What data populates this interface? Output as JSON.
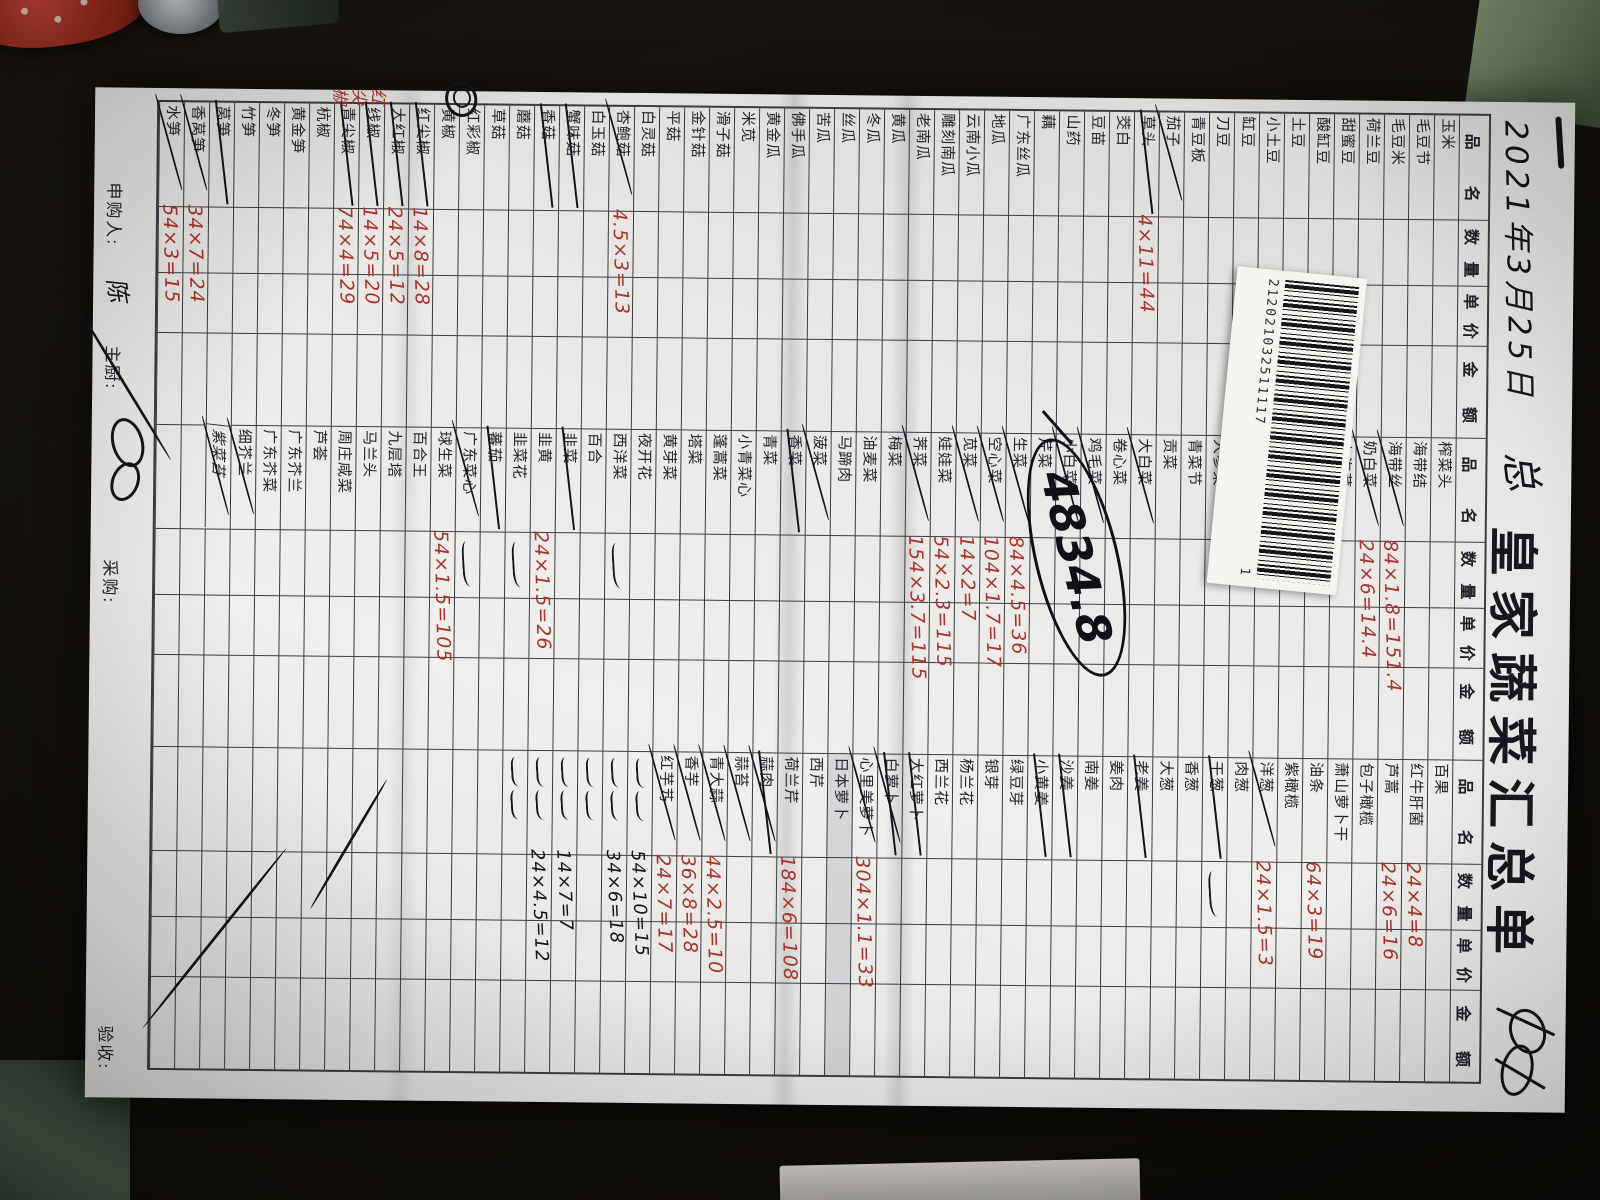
{
  "document": {
    "kind": "handwritten-vegetable-order-summary-photo",
    "date": "2021年3月25日",
    "date_mark": "总",
    "title": "皇家蔬菜汇总单",
    "circled_total": "4834.8",
    "margin_note_red": "红尖椒",
    "barcode_number": "212021032511117",
    "barcode_suffix": "1"
  },
  "footer": {
    "requester_label": "申购人:",
    "requester_signature": "陈",
    "chef_label": "主厨:",
    "buyer_label": "采购:",
    "receiver_label": "验收:"
  },
  "table": {
    "headers": [
      "品名",
      "数量",
      "单价",
      "金额"
    ],
    "rows_per_group": 52,
    "groups": [
      {
        "items": [
          {
            "n": "玉米"
          },
          {
            "n": "毛豆节"
          },
          {
            "n": "毛豆米"
          },
          {
            "n": "荷兰豆"
          },
          {
            "n": "甜蜜豆"
          },
          {
            "n": "酸缸豆"
          },
          {
            "n": "土豆"
          },
          {
            "n": "小土豆"
          },
          {
            "n": "缸豆"
          },
          {
            "n": "刀豆"
          },
          {
            "n": "青豆板"
          },
          {
            "n": "茄子",
            "c": 1
          },
          {
            "n": "草头",
            "s": 1,
            "r": "4×11=44"
          },
          {
            "n": "茭白"
          },
          {
            "n": "豆苗"
          },
          {
            "n": "山药"
          },
          {
            "n": "藕"
          },
          {
            "n": "广东丝瓜"
          },
          {
            "n": "地瓜"
          },
          {
            "n": "云南小瓜"
          },
          {
            "n": "雕刻南瓜"
          },
          {
            "n": "老南瓜"
          },
          {
            "n": "黄瓜"
          },
          {
            "n": "冬瓜"
          },
          {
            "n": "丝瓜"
          },
          {
            "n": "苦瓜"
          },
          {
            "n": "佛手瓜"
          },
          {
            "n": "黄金瓜"
          },
          {
            "n": "米苋"
          },
          {
            "n": "滑子菇"
          },
          {
            "n": "金针菇"
          },
          {
            "n": "平菇"
          },
          {
            "n": "白灵菇"
          },
          {
            "n": "杏鲍菇",
            "c": 1,
            "r": "4.5×3=13"
          },
          {
            "n": "白玉菇"
          },
          {
            "n": "蟹味菇",
            "s": 1
          },
          {
            "n": "香菇",
            "s": 1
          },
          {
            "n": "蘑菇"
          },
          {
            "n": "草菇"
          },
          {
            "n": "红彩椒"
          },
          {
            "n": "黄椒"
          },
          {
            "n": "红尖椒",
            "s": 1,
            "r": "14×8=28"
          },
          {
            "n": "大红椒",
            "s": 1,
            "r": "24×5=12"
          },
          {
            "n": "线椒",
            "s": 1,
            "r": "14×5=20"
          },
          {
            "n": "青尖椒",
            "s": 1,
            "r": "74×4=29"
          },
          {
            "n": "杭椒"
          },
          {
            "n": "黄金笋"
          },
          {
            "n": "冬笋"
          },
          {
            "n": "竹笋"
          },
          {
            "n": "莴笋",
            "s": 1
          },
          {
            "n": "香莴笋",
            "c": 1,
            "r": "34×7=24"
          },
          {
            "n": "水笋",
            "c": 1,
            "r": "54×3=15"
          }
        ]
      },
      {
        "items": [
          {
            "n": "榨菜头"
          },
          {
            "n": "海带结"
          },
          {
            "n": "海带丝",
            "c": 1,
            "r": "84×1.8=151.4"
          },
          {
            "n": "奶白菜",
            "c": 1,
            "r": "24×6=14.4"
          },
          {
            "n": "上海菜"
          },
          {
            "n": ""
          },
          {
            "n": "凤尾菜"
          },
          {
            "n": "围边生菜"
          },
          {
            "n": "观音菜"
          },
          {
            "n": "人参菜"
          },
          {
            "n": "青菜节"
          },
          {
            "n": "贡菜"
          },
          {
            "n": "大白菜",
            "c": 1
          },
          {
            "n": "卷心菜"
          },
          {
            "n": "鸡毛菜",
            "c": 1
          },
          {
            "n": "小白菜",
            "c": 1
          },
          {
            "n": "芹菜"
          },
          {
            "n": "生菜",
            "c": 1,
            "r": "84×4.5=36"
          },
          {
            "n": "空心菜",
            "c": 1,
            "r": "104×1.7=17"
          },
          {
            "n": "苋菜",
            "c": 1,
            "r": "14×2=7"
          },
          {
            "n": "娃娃菜",
            "r": "54×2.3=115"
          },
          {
            "n": "荠菜",
            "c": 1,
            "r": "154×3.7=115"
          },
          {
            "n": "梅菜"
          },
          {
            "n": "油麦菜"
          },
          {
            "n": "马蹄肉"
          },
          {
            "n": "菠菜",
            "c": 1
          },
          {
            "n": "香菜",
            "s": 1
          },
          {
            "n": "青菜"
          },
          {
            "n": "小青菜心"
          },
          {
            "n": "蓬蒿菜"
          },
          {
            "n": "塔菜"
          },
          {
            "n": "黄芽菜"
          },
          {
            "n": "夜开花"
          },
          {
            "n": "西洋菜",
            "bs": 1
          },
          {
            "n": "百合"
          },
          {
            "n": "韭菜",
            "s": 1
          },
          {
            "n": "韭黄",
            "r": "24×1.5=26"
          },
          {
            "n": "韭菜花",
            "bs": 1
          },
          {
            "n": "蕃茄",
            "s": 1
          },
          {
            "n": "广东菜心",
            "c": 1,
            "bs": 1
          },
          {
            "n": "球生菜",
            "r": "54×1.5=105"
          },
          {
            "n": "百合王"
          },
          {
            "n": "九层塔"
          },
          {
            "n": "马兰头"
          },
          {
            "n": "周庄咸菜"
          },
          {
            "n": "芦荟"
          },
          {
            "n": "广东芥兰"
          },
          {
            "n": "广东芥菜"
          },
          {
            "n": "细芥兰",
            "c": 1
          },
          {
            "n": "紫菜苔",
            "h": 1,
            "c": 1
          },
          {
            "n": ""
          },
          {
            "n": ""
          }
        ]
      },
      {
        "items": [
          {
            "n": "百果"
          },
          {
            "n": "红牛肝菌",
            "r": "24×4=8"
          },
          {
            "n": "芦蒿",
            "r": "24×6=16"
          },
          {
            "n": "包子橄榄"
          },
          {
            "n": "萧山萝卜干"
          },
          {
            "n": "油条",
            "r": "64×3=19"
          },
          {
            "n": "紫橄榄"
          },
          {
            "n": "洋葱",
            "c": 1,
            "r": "24×1.5=3"
          },
          {
            "n": "肉葱"
          },
          {
            "n": "干葱",
            "s": 1,
            "bs": 1
          },
          {
            "n": "香葱"
          },
          {
            "n": "大葱"
          },
          {
            "n": "老姜",
            "s": 1
          },
          {
            "n": "姜肉"
          },
          {
            "n": "南姜"
          },
          {
            "n": "沙姜",
            "s": 1
          },
          {
            "n": "小黄姜",
            "s": 1
          },
          {
            "n": "绿豆芽"
          },
          {
            "n": "银芽"
          },
          {
            "n": "杨兰花"
          },
          {
            "n": "西兰花"
          },
          {
            "n": "大红萝卜",
            "s": 1
          },
          {
            "n": "白萝卜",
            "s": 1,
            "c": 1
          },
          {
            "n": "心里美萝卜",
            "c": 1,
            "r": "304×1.1=33"
          },
          {
            "n": "日本萝卜",
            "sh": 1
          },
          {
            "n": "西芹"
          },
          {
            "n": "荷兰芹",
            "r": "184×6=108"
          },
          {
            "n": "蒜肉",
            "s": 1,
            "c": 1
          },
          {
            "n": "蒜苔",
            "c": 1
          },
          {
            "n": "青大蒜",
            "c": 1,
            "r": "44×2.5=10"
          },
          {
            "n": "香芋",
            "c": 1,
            "r": "36×8=28"
          },
          {
            "n": "红芋艿",
            "c": 1,
            "r": "24×7=17"
          },
          {
            "n": "",
            "x": 1,
            "b": "54×10=15"
          },
          {
            "n": "",
            "x": 1,
            "b": "34×6=18"
          },
          {
            "n": "",
            "x": 1
          },
          {
            "n": "",
            "x": 1,
            "b": "14×7=7"
          },
          {
            "n": "",
            "x": 1,
            "b": "24×4.5=12"
          },
          {
            "n": "",
            "x": 1
          },
          {
            "n": ""
          },
          {
            "n": ""
          },
          {
            "n": ""
          },
          {
            "n": ""
          }
        ]
      }
    ]
  }
}
